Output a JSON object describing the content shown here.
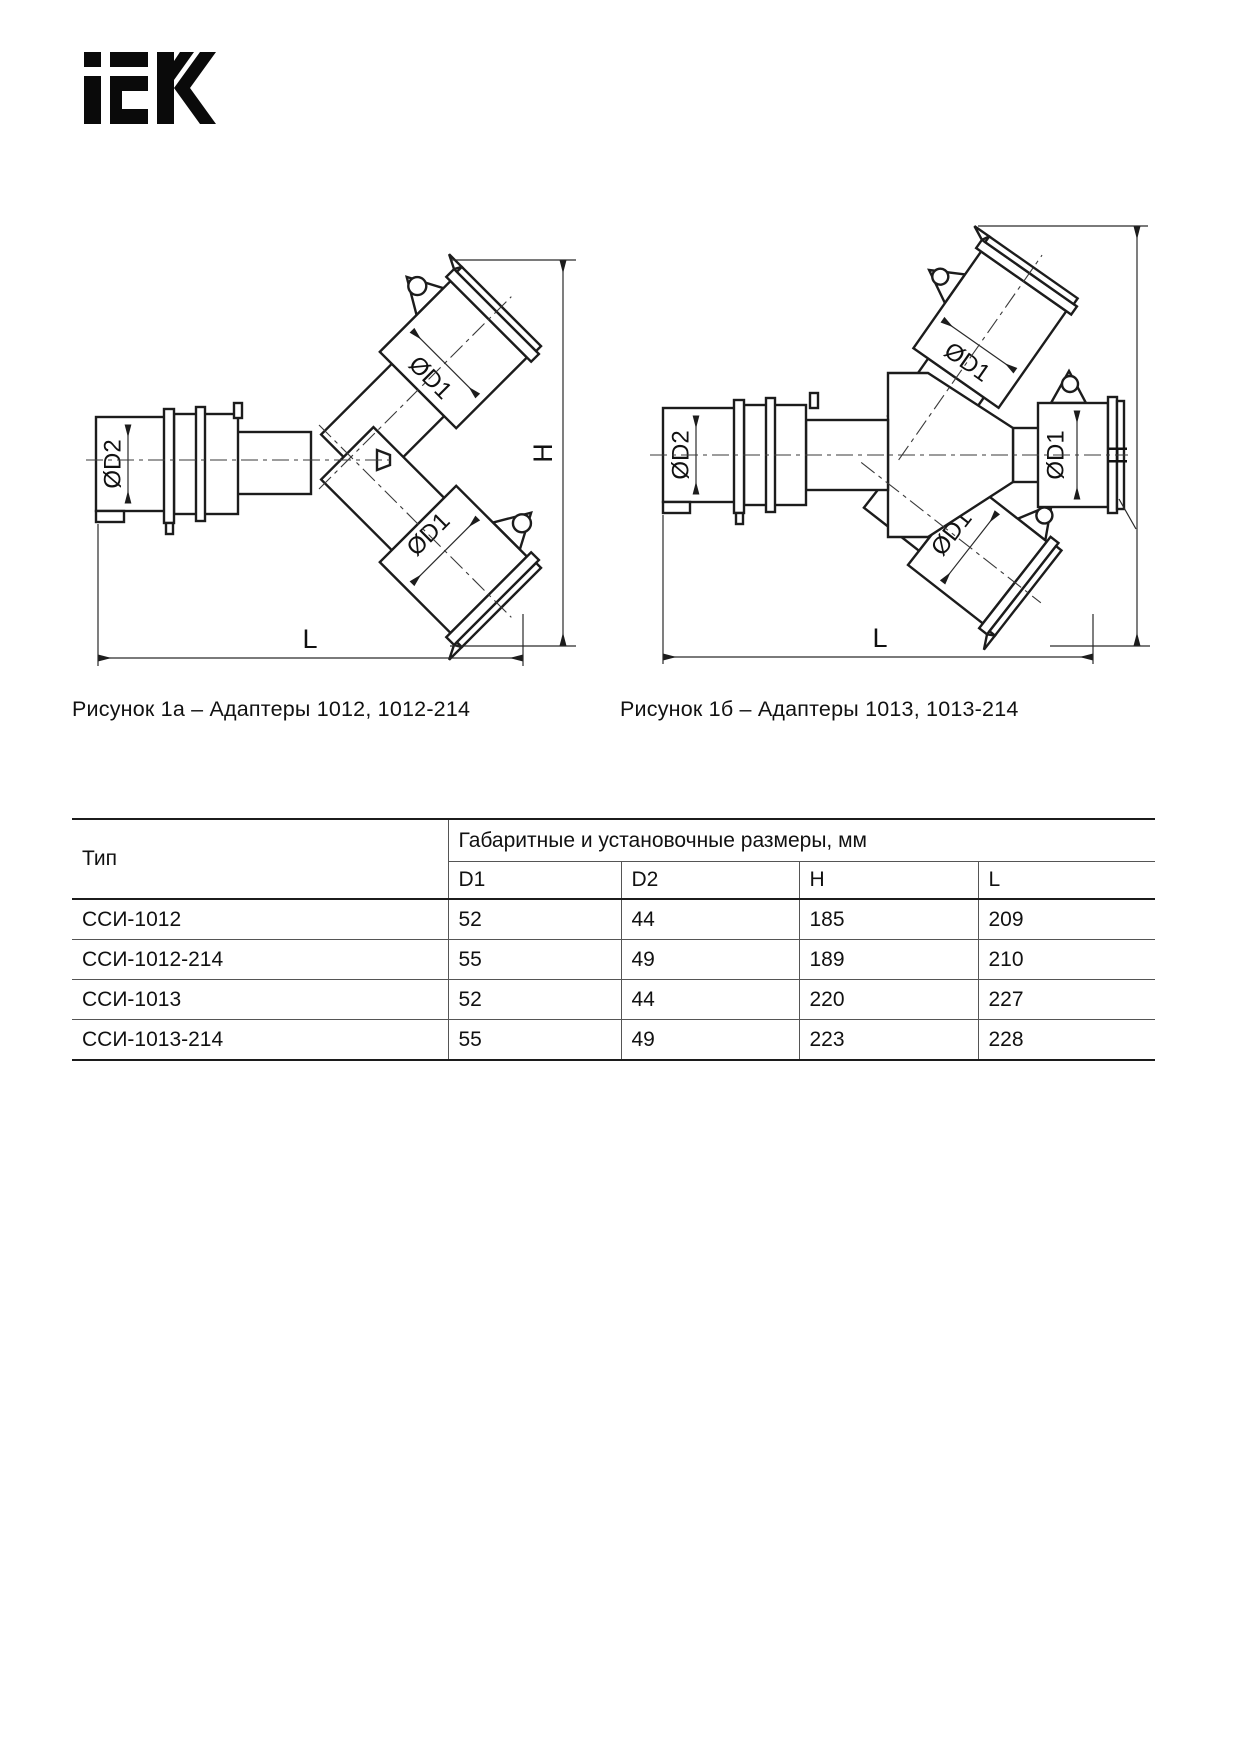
{
  "logo": {
    "text": "iEK"
  },
  "figures": [
    {
      "caption": "Рисунок 1а – Адаптеры 1012, 1012-214",
      "labels": {
        "d2": "ØD2",
        "d1_upper": "ØD1",
        "d1_lower": "ØD1",
        "h": "H",
        "l": "L"
      }
    },
    {
      "caption": "Рисунок 1б – Адаптеры 1013, 1013-214",
      "labels": {
        "d2": "ØD2",
        "d1_top": "ØD1",
        "d1_right": "ØD1",
        "d1_bottom": "ØD1",
        "h": "H",
        "l": "L"
      }
    }
  ],
  "table": {
    "col1_header": "Тип",
    "group_header": "Габаритные и установочные размеры, мм",
    "sub_headers": [
      "D1",
      "D2",
      "H",
      "L"
    ],
    "rows": [
      {
        "type": "ССИ-1012",
        "values": [
          "52",
          "44",
          "185",
          "209"
        ]
      },
      {
        "type": "ССИ-1012-214",
        "values": [
          "55",
          "49",
          "189",
          "210"
        ]
      },
      {
        "type": "ССИ-1013",
        "values": [
          "52",
          "44",
          "220",
          "227"
        ]
      },
      {
        "type": "ССИ-1013-214",
        "values": [
          "55",
          "49",
          "223",
          "228"
        ]
      }
    ]
  }
}
